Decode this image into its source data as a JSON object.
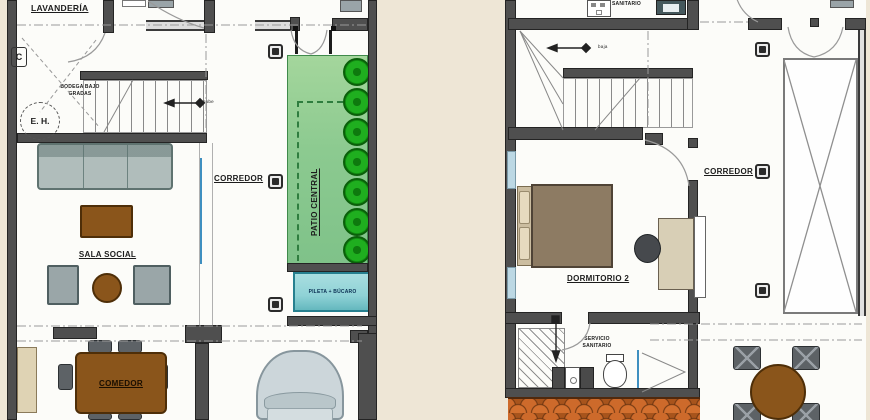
{
  "title": "Planos arquitectónicos - dos plantas",
  "colors": {
    "bg": "#eee6d6",
    "wall": "#4f4f4f",
    "patio_green": "#8cca90",
    "tree_green": "#1fae1f",
    "pool_teal": "#8fd2d6",
    "wood_brown": "#8a551b",
    "roof_tile": "#c8682a",
    "sofa_gray": "#b0bdbb",
    "bed_brown": "#8d7b63",
    "car_gray": "#ccd6da",
    "window_blue": "#bcd8e4",
    "glass_blue": "#3f8fc0",
    "chair_dark": "#5d6266",
    "desk_tan": "#d8cfb6",
    "text": "#1c1c1c"
  },
  "left_plan": {
    "labels": {
      "lavanderia": "LAVANDERÍA",
      "closet": "C",
      "eh": "E. H.",
      "bodega1": "BODEGA BAJO",
      "bodega2": "GRADAS",
      "sube": "sube",
      "visitas": "S.S. VISITAS",
      "sala": "SALA SOCIAL",
      "corredor": "CORREDOR",
      "patio": "PATIO CENTRAL",
      "pileta": "PILETA + BÚCARO",
      "comedor": "COMEDOR"
    }
  },
  "right_plan": {
    "labels": {
      "sanitario": "SANITARIO",
      "baja": "baja",
      "dormitorio": "DORMITORIO 2",
      "corredor": "CORREDOR",
      "servicio1": "SERVICIO",
      "servicio2": "SANITARIO"
    }
  }
}
